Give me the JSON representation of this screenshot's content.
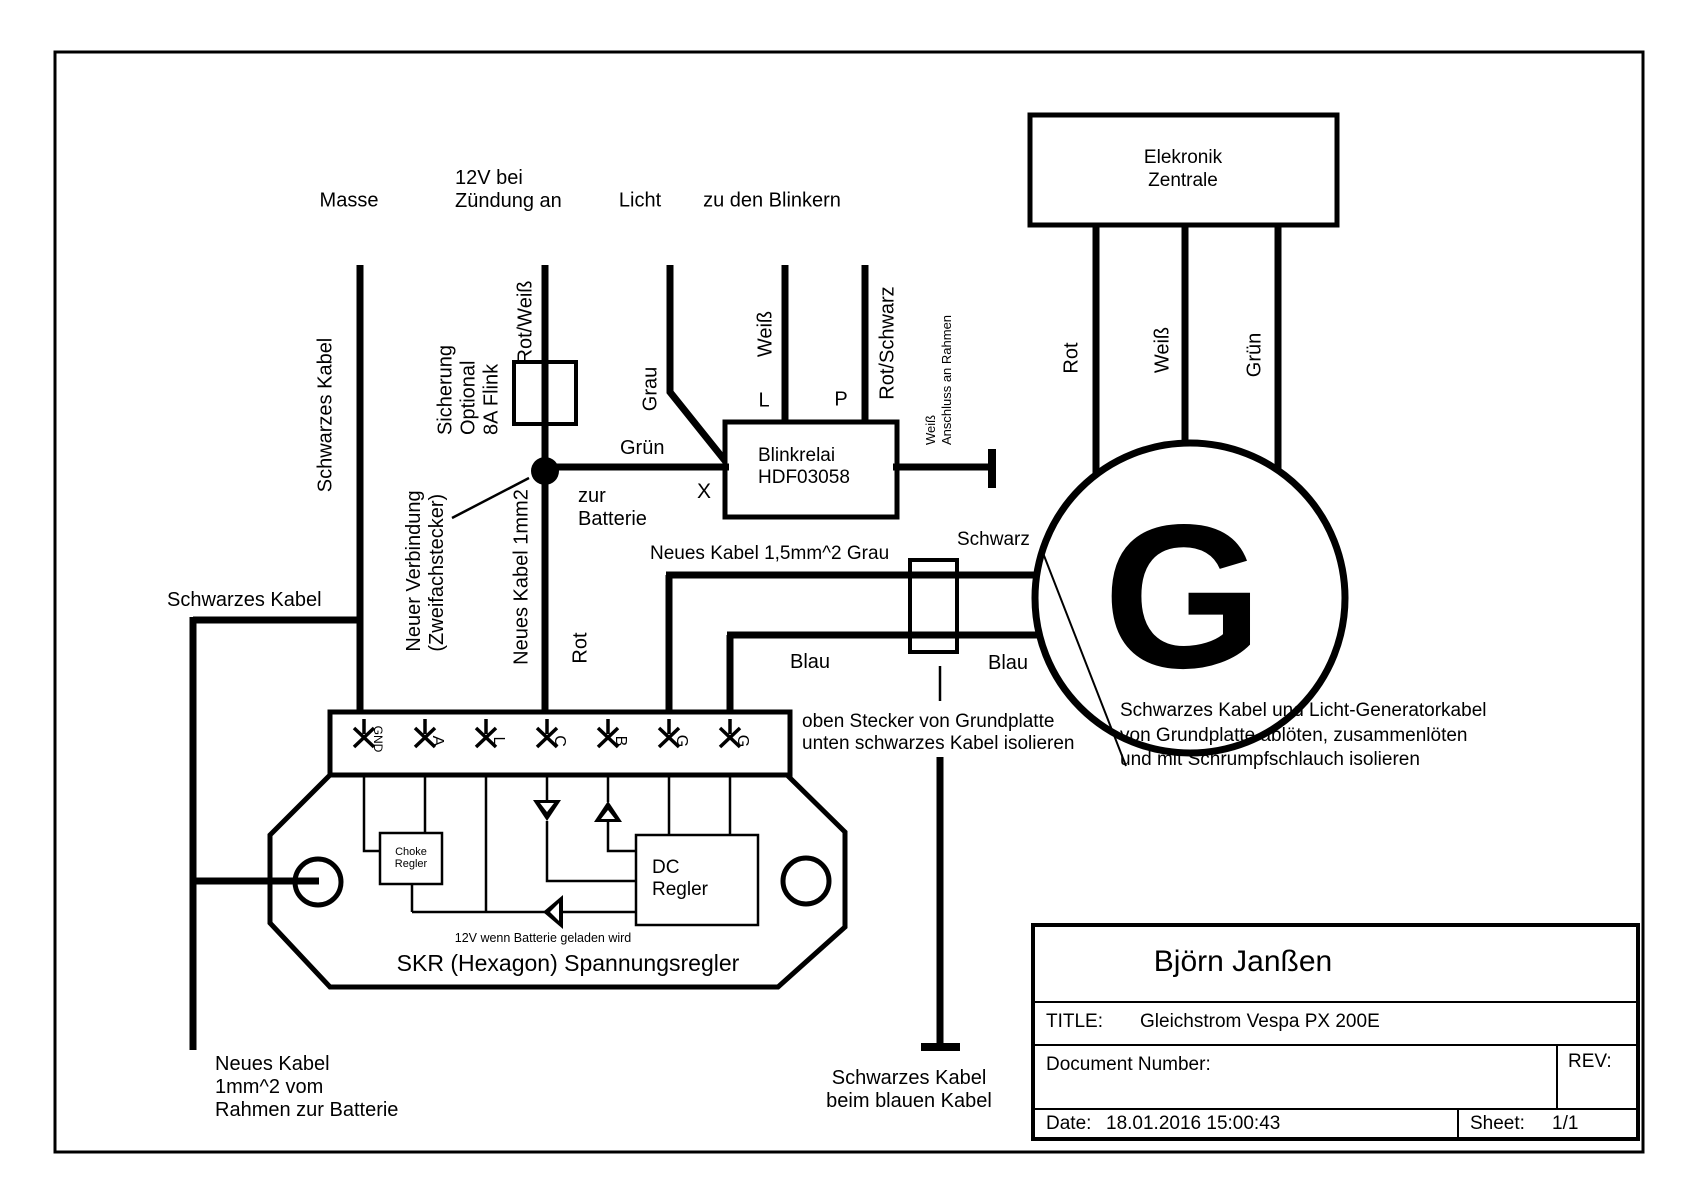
{
  "header": {
    "masse": "Masse",
    "ignition_line1": "12V bei",
    "ignition_line2": "Zündung an",
    "licht": "Licht",
    "blinker": "zu den Blinkern"
  },
  "left": {
    "schwarzes_kabel_vertical": "Schwarzes Kabel",
    "schwarzes_kabel_horizontal": "Schwarzes Kabel",
    "battery_note_line1": "Neues Kabel",
    "battery_note_line2": "1mm^2 vom",
    "battery_note_line3": "Rahmen zur Batterie"
  },
  "fuse": {
    "line1": "Sicherung",
    "line2": "Optional",
    "line3": "8A Flink"
  },
  "center": {
    "rot_weiss": "Rot/Weiß",
    "neuer_verbindung_line1": "Neuer Verbindung",
    "neuer_verbindung_line2": "(Zweifachstecker)",
    "neues_kabel_1mm2": "Neues Kabel 1mm2",
    "zur_batterie_line1": "zur",
    "zur_batterie_line2": "Batterie",
    "rot": "Rot",
    "gruen": "Grün",
    "x": "X",
    "grau": "Grau"
  },
  "relay": {
    "name": "Blinkrelai",
    "model": "HDF03058",
    "l": "L",
    "p": "P",
    "weiss": "Weiß",
    "rot_schwarz": "Rot/Schwarz",
    "anschluss_line1": "Weiß",
    "anschluss_line2": "Anschluss an Rahmen"
  },
  "zentrale": {
    "name_line1": "Elekronik",
    "name_line2": "Zentrale",
    "rot": "Rot",
    "weiss": "Weiß",
    "gruen": "Grün"
  },
  "generator": {
    "letter": "G",
    "schwarz": "Schwarz",
    "blau_left": "Blau",
    "blau_right": "Blau",
    "grau_kabel": "Neues Kabel 1,5mm^2 Grau",
    "stecker_note_line1": "oben Stecker von Grundplatte",
    "stecker_note_line2": "unten schwarzes Kabel isolieren",
    "schwarz_blau_line1": "Schwarzes Kabel",
    "schwarz_blau_line2": "beim blauen Kabel",
    "solder_note_line1": "Schwarzes Kabel und Licht-Generatorkabel",
    "solder_note_line2": "von Grundplatte ablöten, zusammenlöten",
    "solder_note_line3": "und mit Schrumpfschlauch isolieren"
  },
  "regulator": {
    "terminals": [
      "GND",
      "A",
      "L",
      "C",
      "B",
      "G",
      "G"
    ],
    "choke_line1": "Choke",
    "choke_line2": "Regler",
    "dc_line1": "DC",
    "dc_line2": "Regler",
    "note": "12V wenn Batterie geladen wird",
    "name": "SKR (Hexagon) Spannungsregler"
  },
  "titleblock": {
    "author": "Björn Janßen",
    "title_label": "TITLE:",
    "title": "Gleichstrom Vespa PX 200E",
    "doc_label": "Document Number:",
    "rev_label": "REV:",
    "date_label": "Date:",
    "date": "18.01.2016 15:00:43",
    "sheet_label": "Sheet:",
    "sheet": "1/1"
  }
}
